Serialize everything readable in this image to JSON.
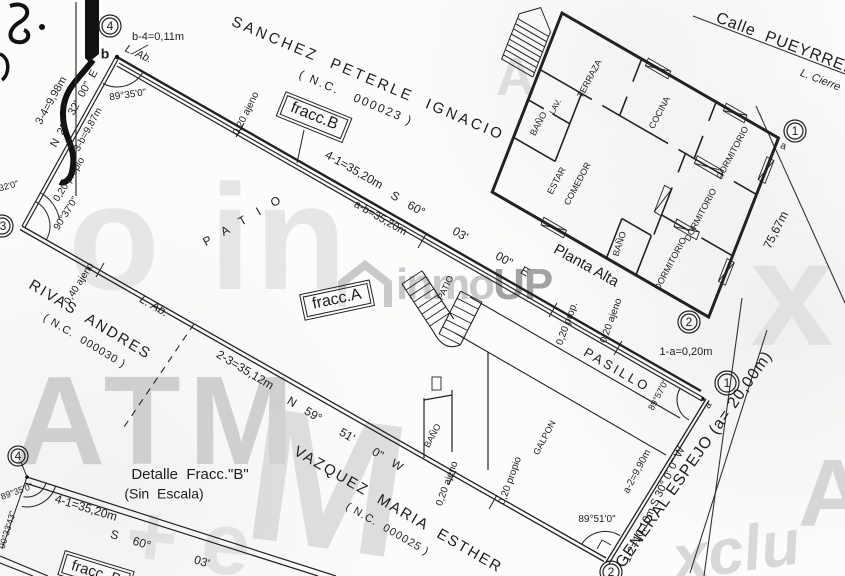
{
  "streets": {
    "pueyrredon": {
      "name": "Calle  PUEYRRED",
      "closure_line": "L. Cierre"
    },
    "espejo": {
      "name": "GENERAL ESPEJO (a= 20,00m)"
    },
    "frontage_run": "75,67m"
  },
  "neighbors": {
    "north": {
      "name": "SANCHEZ  PETERLE  IGNACIO",
      "nc": "( N.C.   000023 )"
    },
    "west": {
      "name": "RIVAS  ANDRES",
      "nc": "( N.C.  000030 )"
    },
    "south": {
      "name": "VAZQUEZ  MARIA  ESTHER",
      "nc": "( N.C.  000025 )"
    }
  },
  "parcel": {
    "vertex_4": "4",
    "vertex_3": "3",
    "vertex_1": "1",
    "vertex_2": "2",
    "vertex_1_street": "1",
    "vertex_2_house": "2",
    "vertex_4_detail": "4",
    "point_b": "b",
    "point_a": "a",
    "point_a_street": "a",
    "side_top_dim": "4-1=35,20m",
    "side_top_bearing": "S 60°   03'   00\" E",
    "side_top_aux": "a-b=35,20m",
    "side_left_dim": "3-4=9,98m",
    "side_left_bearing": "N 29° 32' 00\" E",
    "side_left_aux": "3-b=9,87m",
    "tie_b4": "b-4=0,11m",
    "tie_1a": "1-a=0,20m",
    "side_bottom_dim": "2-3=35,12m",
    "side_bottom_bearing": "N 59°  51'  0\" W",
    "side_right_dim": "1-2=10,10m S 30° 0' 0\" W",
    "side_right_aux": "a-2=9,90m",
    "angle_b": "89°35'0\"",
    "angle_3": "90°37'0\"",
    "angle_3_edge": "°32'0\"",
    "angle_1": "89°57'0\"",
    "angle_2": "89°51'0\"",
    "line_ab_top": "L. Ab.",
    "line_ab_bottom": "L. Ab."
  },
  "offsets": {
    "top_near_b": "0,20 ajeno",
    "left_propio": "0,20 propio",
    "bottom_040": "0,40 ajeno",
    "mid_propio": "0,20 prop.",
    "mid_ajeno": "0,20 ajeno",
    "bottom_ajeno": "0,20 ajeno",
    "bottom_propio": "0,20 propio"
  },
  "fractions": {
    "a": "fracc.A",
    "b": "fracc.B",
    "b_detail": "fracc. B"
  },
  "areas": {
    "patio_big": "P A T I O",
    "patio_small": "PATIO",
    "pasillo": "PASILLO",
    "galpon": "GALPON",
    "galpon_bano": "BAÑO"
  },
  "planta_alta": {
    "label": "Planta Alta",
    "terraza": "TERRAZA",
    "bano_top": "BAÑO",
    "lav": "LAV.",
    "cocina": "COCINA",
    "estar": "ESTAR",
    "comedor": "COMEDOR",
    "dorm_1": "DORMITORIO",
    "dorm_2": "DORMITORIO",
    "dorm_3": "DORMITORIO",
    "bano_mid": "BAÑO"
  },
  "detail": {
    "title": "Detalle  Fracc.\"B\"",
    "subtitle": "(Sin  Escala)",
    "dim": "4-1=35,20m",
    "bearing": "S 60°   03'",
    "angle_a": "89°35'0\"",
    "angle_b": "90°33'43\""
  },
  "watermark": {
    "logo_inmo": "inmo",
    "logo_up": "UP",
    "frag_atm": "ATM",
    "frag_oin": "o in",
    "frag_m": "M",
    "frag_x": "x",
    "frag_xclu": "xclu",
    "frag_pe": "+ e",
    "frag_a1": "A",
    "frag_a2": "A"
  }
}
